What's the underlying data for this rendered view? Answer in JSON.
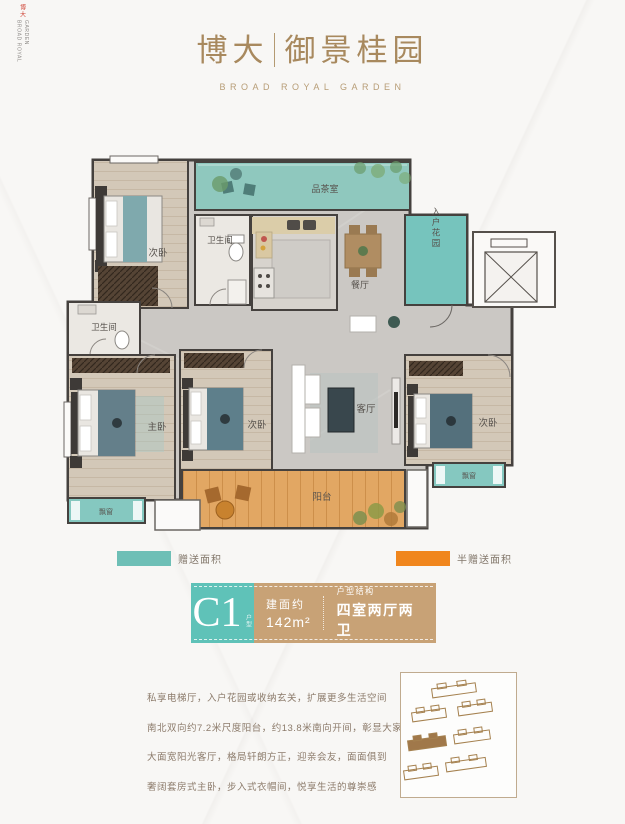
{
  "side_brand": {
    "mark": "博大",
    "text": "BROAD ROYAL GARDEN"
  },
  "header": {
    "cn_left": "博大",
    "cn_right": "御景桂园",
    "en": "BROAD ROYAL GARDEN"
  },
  "plan": {
    "labels": {
      "bedroom_top_left": "次卧",
      "tea_room": "品茶室",
      "bathroom_top": "卫生间",
      "dining": "餐厅",
      "entry_garden": "入户花园",
      "bathroom_left": "卫生间",
      "master_bedroom": "主卧",
      "bedroom_middle": "次卧",
      "living_room": "客厅",
      "bedroom_right": "次卧",
      "balcony": "阳台",
      "bay_window_left": "飘窗",
      "bay_window_right": "飘窗"
    }
  },
  "legend": {
    "gift": {
      "label": "赠送面积",
      "color": "#6ebfb6"
    },
    "half_gift": {
      "label": "半赠送面积",
      "color": "#f0861d"
    }
  },
  "unit_card": {
    "code": "C1",
    "code_tag": "户型",
    "area_label": "建面约",
    "area_value": "142m²",
    "structure_label": "户型结构",
    "structure_value": "四室两厅两卫",
    "teal": "#5fc2b8",
    "tan": "#c8a276"
  },
  "description": {
    "line1": "私享电梯厅，入户花园或收纳玄关，扩展更多生活空间",
    "line2": "南北双向约7.2米尺度阳台，约13.8米南向开间，彰显大家风范",
    "line3": "大面宽阳光客厅，格局轩朗方正，迎亲会友，面面俱到",
    "line4": "奢阔套房式主卧，步入式衣帽间，悦享生活的尊崇感"
  },
  "colors": {
    "gold": "#a8895e",
    "wall": "#45413e",
    "balcony_orange": "#e2a763",
    "room_teal": "#8fc8be"
  }
}
